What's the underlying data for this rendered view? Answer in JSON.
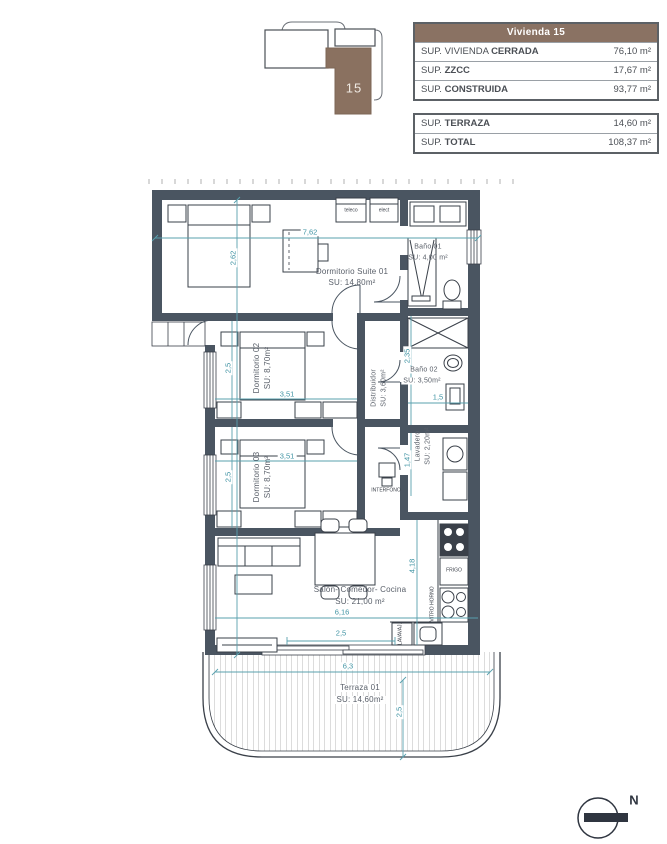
{
  "locator": {
    "unit": "15"
  },
  "area_table": {
    "title": "Vivienda 15",
    "main_rows": [
      {
        "prefix": "SUP. VIVIENDA ",
        "label": "CERRADA",
        "value": "76,10 m²"
      },
      {
        "prefix": "SUP. ",
        "label": "ZZCC",
        "value": "17,67 m²"
      },
      {
        "prefix": "SUP. ",
        "label": "CONSTRUIDA",
        "value": "93,77 m²"
      }
    ],
    "total_rows": [
      {
        "prefix": "SUP. ",
        "label": "TERRAZA",
        "value": "14,60 m²"
      },
      {
        "prefix": "SUP. ",
        "label": "TOTAL",
        "value": "108,37 m²"
      }
    ]
  },
  "rooms": {
    "suite": {
      "name": "Dormitorio Suite 01",
      "area": "SU: 14,80m²"
    },
    "bano1": {
      "name": "Baño 01",
      "area": "SU: 4,00 m²"
    },
    "dorm2": {
      "name": "Dormitorio 02",
      "area": "SU: 8,70m²"
    },
    "dorm3": {
      "name": "Dormitorio 03",
      "area": "SU: 8,70m²"
    },
    "bano2": {
      "name": "Baño 02",
      "area": "SU: 3,50m²"
    },
    "distribuidor": {
      "name": "Distribuidor",
      "area": "SU: 3,60m²"
    },
    "lavadero": {
      "name": "Lavadero",
      "area": "SU: 2,20m²"
    },
    "salon": {
      "name": "Salón- Comedor- Cocina",
      "area": "SU: 21,00 m²"
    },
    "terraza": {
      "name": "Terraza 01",
      "area": "SU: 14,60m²"
    }
  },
  "dimensions": {
    "suite_w": "7,62",
    "suite_h": "2,62",
    "dorm2_h": "2,5",
    "dorm2_w": "3,51",
    "dorm3_h": "2,5",
    "dorm3_w": "3,51",
    "bano2_h": "2,35",
    "bano2_w": "1,5",
    "lavadero_h": "1,47",
    "salon_h": "4,18",
    "salon_w": "6,16",
    "salon_door_w": "2,5",
    "terraza_w": "6,3",
    "terraza_h": "2,5"
  },
  "fixtures": {
    "teleco": "teleco",
    "elect": "elect",
    "frigo": "FRIGO",
    "vitro": "VITRO HORNO",
    "lavavajillas": "LAVAVAJ.",
    "interfono": "INTERFONO"
  },
  "compass": {
    "north": "N"
  },
  "colors": {
    "wall": "#4a5561",
    "dimension": "#58a0ae",
    "brand_brown": "#8a7263"
  }
}
